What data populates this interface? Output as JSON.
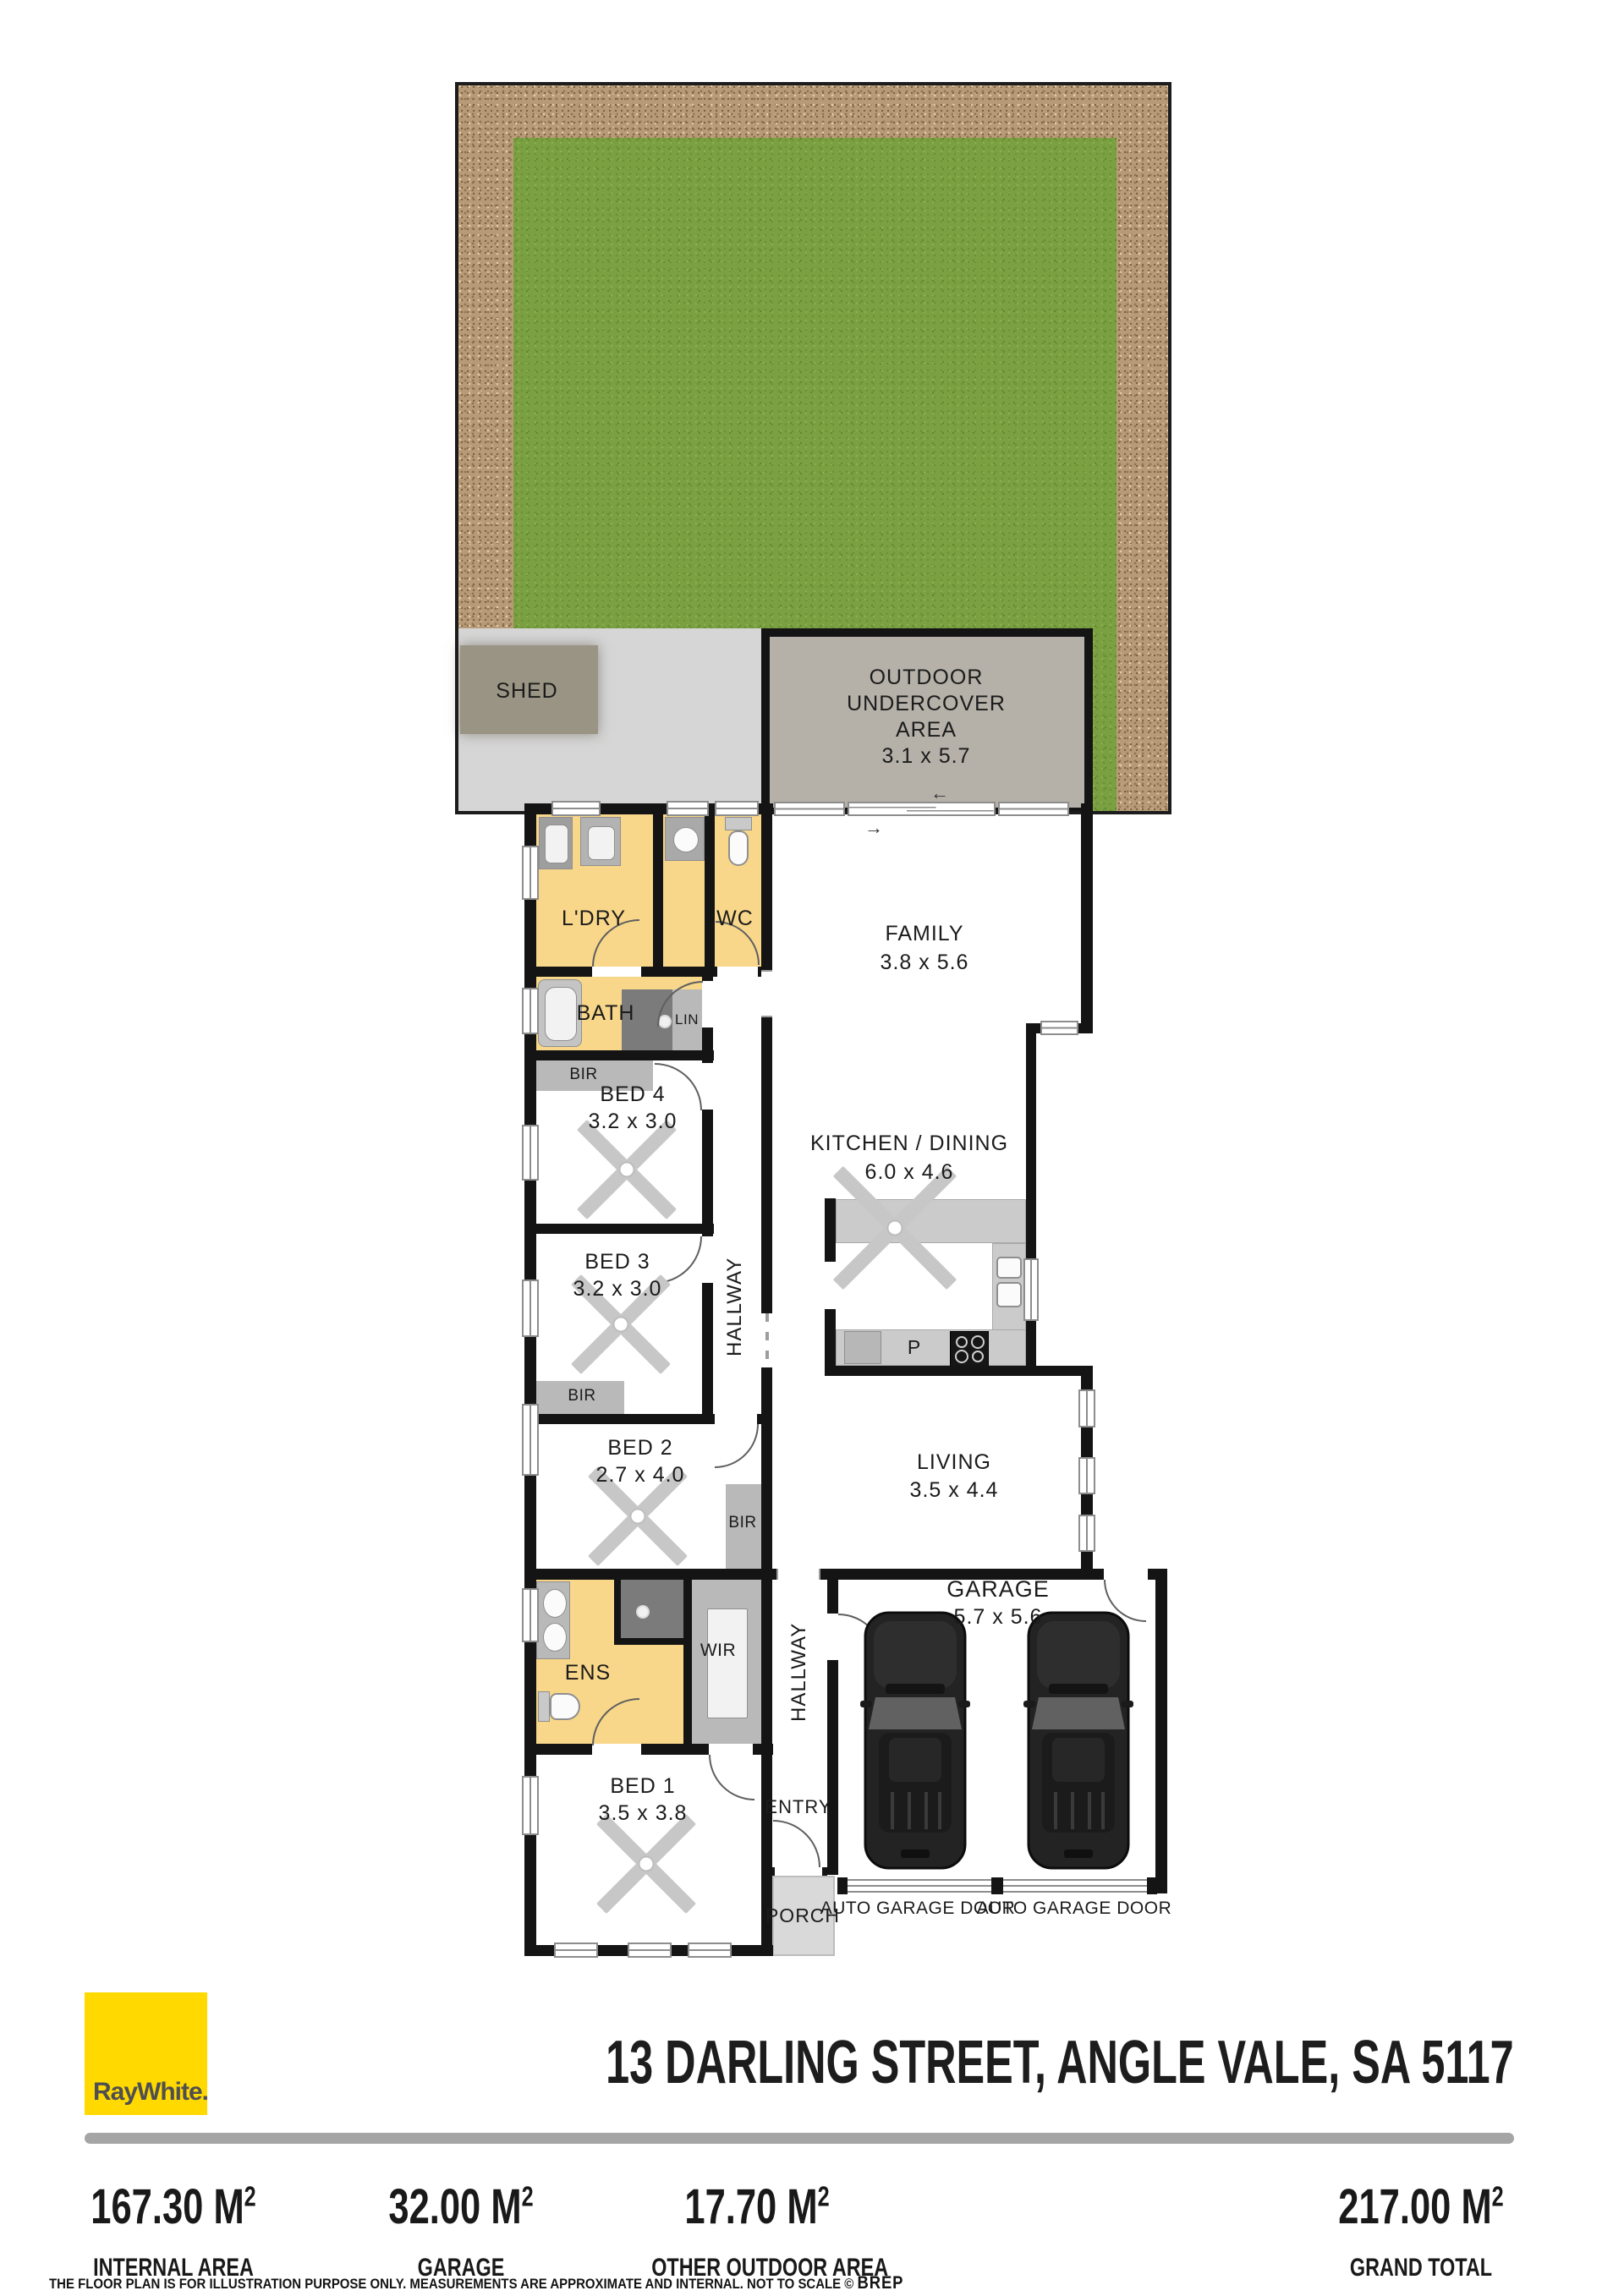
{
  "plan": {
    "shed": "SHED",
    "undercover": [
      "OUTDOOR",
      "UNDERCOVER",
      "AREA"
    ],
    "undercover_dims": "3.1 x 5.7",
    "ldry": "L'DRY",
    "wc": "WC",
    "family": "FAMILY",
    "family_dims": "3.8 x 5.6",
    "bath": "BATH",
    "lin": "LIN",
    "bir": "BIR",
    "bed4": "BED 4",
    "bed4_dims": "3.2 x 3.0",
    "hallway": "HALLWAY",
    "kitchen": "KITCHEN / DINING",
    "kitchen_dims": "6.0 x 4.6",
    "bed3": "BED 3",
    "bed3_dims": "3.2 x 3.0",
    "bed2": "BED 2",
    "bed2_dims": "2.7 x 4.0",
    "living": "LIVING",
    "living_dims": "3.5 x 4.4",
    "pantry": "P",
    "ens": "ENS",
    "wir": "WIR",
    "garage": "GARAGE",
    "garage_dims": "5.7 x 5.6",
    "bed1": "BED 1",
    "bed1_dims": "3.5 x 3.8",
    "entry": "ENTRY",
    "porch": "PORCH",
    "auto_garage_door": "AUTO GARAGE DOOR",
    "icons": {
      "door_swing_left": "←",
      "door_swing_right": "→"
    }
  },
  "footer": {
    "brand": "RayWhite.",
    "address": "13 DARLING STREET, ANGLE VALE, SA 5117",
    "unit": "M",
    "unit_sup": "2",
    "stats": [
      {
        "value": "167.30",
        "label": "INTERNAL AREA"
      },
      {
        "value": "32.00",
        "label": "GARAGE"
      },
      {
        "value": "17.70",
        "label": "OTHER OUTDOOR AREA"
      },
      {
        "value": "217.00",
        "label": "GRAND TOTAL"
      }
    ],
    "disclaimer": "THE FLOOR PLAN IS FOR ILLUSTRATION PURPOSE ONLY. MEASUREMENTS ARE APPROXIMATE AND INTERNAL. NOT TO SCALE © ",
    "brep": "BREP"
  },
  "colors": {
    "brand_yellow": "#FFD900",
    "room_yellow": "#F8D78A",
    "wall_black": "#141414",
    "grass_green": "#7AA042",
    "dirt_brown": "#B79B79",
    "patio_gray": "#D6D6D6",
    "undercover_gray": "#B5B0A8",
    "closet_gray": "#B9B9B9",
    "shower_gray": "#7B7B7B",
    "divider_gray": "#A5A5A5"
  }
}
